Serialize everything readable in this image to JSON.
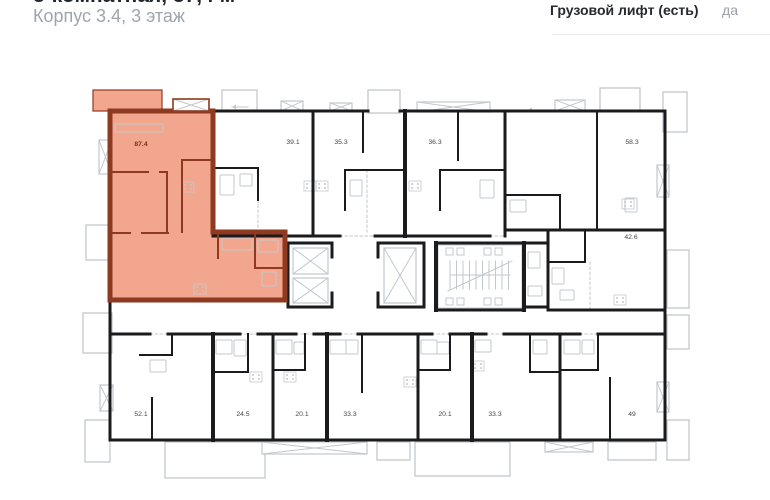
{
  "header": {
    "title": "3-комнатная, 87,4 м²",
    "subtitle": "Корпус 3.4, 3 этаж"
  },
  "info": {
    "label": "Грузовой лифт (есть)",
    "value": "да"
  },
  "colors": {
    "highlight_fill": "#F3A68E",
    "highlight_wall": "#8E3A21",
    "highlight_text": "#7C3118",
    "wall": "#1B1B1D",
    "light": "#C3C8CD",
    "label": "#41464C",
    "title": "#23262B",
    "muted": "#9AA0A8",
    "divider": "#ECECEE"
  },
  "floorplan": {
    "highlight": {
      "area_label": "87.4",
      "label_x": 141,
      "label_y": 146,
      "polygon": "110,111 213,111 213,232 285,232 285,300 110,300",
      "balcony": [
        93,
        90,
        69,
        21
      ],
      "hatch_red": [
        173,
        99,
        36,
        12
      ]
    },
    "unit_labels": [
      {
        "t": "39.1",
        "x": 293,
        "y": 144
      },
      {
        "t": "35.3",
        "x": 341,
        "y": 144
      },
      {
        "t": "36.3",
        "x": 435,
        "y": 144
      },
      {
        "t": "58.3",
        "x": 632,
        "y": 144
      },
      {
        "t": "42.6",
        "x": 631,
        "y": 239
      },
      {
        "t": "52.1",
        "x": 141,
        "y": 416
      },
      {
        "t": "24.5",
        "x": 243,
        "y": 416
      },
      {
        "t": "20.1",
        "x": 302,
        "y": 416
      },
      {
        "t": "33.3",
        "x": 350,
        "y": 416
      },
      {
        "t": "20.1",
        "x": 445,
        "y": 416
      },
      {
        "t": "33.3",
        "x": 495,
        "y": 416
      },
      {
        "t": "49",
        "x": 632,
        "y": 416
      }
    ],
    "walls_black": [
      [
        110,
        111,
        110,
        440
      ],
      [
        110,
        440,
        665,
        440
      ],
      [
        665,
        111,
        665,
        440
      ],
      [
        213,
        111,
        368,
        111
      ],
      [
        400,
        111,
        665,
        111
      ],
      [
        313,
        111,
        313,
        236
      ],
      [
        405,
        111,
        405,
        236,
        4
      ],
      [
        505,
        111,
        505,
        236
      ],
      [
        505,
        230,
        665,
        230
      ],
      [
        597,
        113,
        597,
        228,
        2
      ],
      [
        548,
        232,
        548,
        308
      ],
      [
        548,
        310,
        665,
        310
      ],
      [
        213,
        236,
        340,
        236
      ],
      [
        375,
        236,
        490,
        236
      ],
      [
        288,
        243,
        332,
        243
      ],
      [
        288,
        307,
        332,
        307
      ],
      [
        288,
        243,
        288,
        307
      ],
      [
        332,
        243,
        332,
        257
      ],
      [
        332,
        293,
        332,
        307
      ],
      [
        378,
        243,
        424,
        243
      ],
      [
        378,
        307,
        424,
        307
      ],
      [
        378,
        243,
        378,
        257
      ],
      [
        378,
        293,
        378,
        307
      ],
      [
        424,
        243,
        424,
        307
      ],
      [
        436,
        243,
        524,
        243
      ],
      [
        436,
        310,
        524,
        310
      ],
      [
        436,
        243,
        436,
        310,
        4
      ],
      [
        524,
        243,
        524,
        310,
        4
      ],
      [
        524,
        243,
        548,
        243
      ],
      [
        524,
        307,
        548,
        307
      ],
      [
        110,
        334,
        150,
        334
      ],
      [
        168,
        334,
        240,
        334
      ],
      [
        258,
        334,
        296,
        334
      ],
      [
        314,
        334,
        340,
        334
      ],
      [
        358,
        334,
        432,
        334
      ],
      [
        450,
        334,
        486,
        334
      ],
      [
        504,
        334,
        580,
        334
      ],
      [
        598,
        334,
        665,
        334
      ],
      [
        213,
        334,
        213,
        440,
        4
      ],
      [
        273,
        334,
        273,
        440
      ],
      [
        327,
        334,
        327,
        440,
        4
      ],
      [
        418,
        334,
        418,
        440
      ],
      [
        472,
        334,
        472,
        440,
        4
      ],
      [
        560,
        334,
        560,
        440
      ],
      [
        248,
        334,
        248,
        372,
        2
      ],
      [
        213,
        372,
        248,
        372,
        2
      ],
      [
        305,
        334,
        305,
        370,
        2
      ],
      [
        273,
        370,
        305,
        370,
        2
      ],
      [
        362,
        334,
        362,
        392,
        2
      ],
      [
        450,
        334,
        450,
        370,
        2
      ],
      [
        418,
        370,
        450,
        370,
        2
      ],
      [
        530,
        334,
        530,
        372,
        2
      ],
      [
        530,
        372,
        560,
        372,
        2
      ],
      [
        598,
        334,
        598,
        370,
        2
      ],
      [
        560,
        370,
        598,
        370,
        2
      ],
      [
        610,
        378,
        610,
        440,
        2
      ],
      [
        152,
        398,
        152,
        440,
        2
      ],
      [
        140,
        355,
        172,
        355,
        2
      ],
      [
        172,
        334,
        172,
        355,
        2
      ],
      [
        213,
        168,
        258,
        168,
        2
      ],
      [
        258,
        168,
        258,
        200,
        2
      ],
      [
        363,
        112,
        363,
        152,
        2
      ],
      [
        458,
        112,
        458,
        160,
        2
      ],
      [
        345,
        170,
        405,
        170,
        2
      ],
      [
        345,
        170,
        345,
        210,
        2
      ],
      [
        440,
        170,
        505,
        170,
        2
      ],
      [
        440,
        170,
        440,
        210,
        2
      ],
      [
        505,
        195,
        560,
        195,
        2
      ],
      [
        560,
        195,
        560,
        230,
        2
      ],
      [
        548,
        262,
        585,
        262,
        2
      ],
      [
        585,
        232,
        585,
        262,
        2
      ]
    ],
    "walls_red": [
      [
        110,
        111,
        110,
        300
      ],
      [
        110,
        111,
        213,
        111
      ],
      [
        213,
        111,
        213,
        232
      ],
      [
        213,
        232,
        285,
        232
      ],
      [
        285,
        232,
        285,
        300
      ],
      [
        110,
        300,
        285,
        300
      ]
    ],
    "walls_red_thin": [
      [
        110,
        172,
        148,
        172
      ],
      [
        160,
        172,
        167,
        172
      ],
      [
        167,
        172,
        167,
        232
      ],
      [
        110,
        233,
        130,
        233
      ],
      [
        142,
        233,
        168,
        233
      ],
      [
        182,
        160,
        213,
        160
      ],
      [
        182,
        160,
        182,
        232
      ],
      [
        255,
        235,
        255,
        268
      ],
      [
        255,
        268,
        285,
        268
      ],
      [
        218,
        232,
        218,
        258
      ]
    ],
    "balconies_outline": [
      [
        222,
        90,
        35,
        21
      ],
      [
        368,
        90,
        32,
        23
      ],
      [
        600,
        88,
        40,
        23
      ],
      [
        663,
        92,
        24,
        40
      ],
      [
        667,
        250,
        22,
        58
      ],
      [
        667,
        315,
        22,
        34
      ],
      [
        667,
        420,
        22,
        40
      ],
      [
        165,
        442,
        100,
        36
      ],
      [
        377,
        442,
        33,
        18
      ],
      [
        415,
        442,
        95,
        34
      ],
      [
        608,
        442,
        48,
        18
      ],
      [
        86,
        225,
        24,
        35
      ],
      [
        83,
        313,
        29,
        40
      ],
      [
        85,
        420,
        25,
        42
      ]
    ],
    "balconies_hatch": [
      [
        281,
        101,
        22,
        10
      ],
      [
        330,
        103,
        22,
        8
      ],
      [
        417,
        102,
        73,
        10
      ],
      [
        555,
        100,
        30,
        11
      ],
      [
        99,
        140,
        13,
        34
      ],
      [
        100,
        385,
        13,
        26
      ],
      [
        657,
        165,
        12,
        32
      ],
      [
        657,
        382,
        12,
        30
      ],
      [
        262,
        442,
        105,
        12
      ],
      [
        545,
        442,
        48,
        10
      ]
    ],
    "elevators": [
      [
        293,
        248,
        35,
        26
      ],
      [
        293,
        278,
        35,
        25
      ],
      [
        384,
        248,
        32,
        55
      ]
    ],
    "stair": {
      "x": 438,
      "y": 245,
      "w": 84,
      "h": 63
    },
    "stoves": [
      [
        188,
        187
      ],
      [
        310,
        186
      ],
      [
        322,
        186
      ],
      [
        415,
        186
      ],
      [
        628,
        204
      ],
      [
        620,
        300
      ],
      [
        256,
        377
      ],
      [
        290,
        377
      ],
      [
        410,
        382
      ],
      [
        478,
        366
      ],
      [
        200,
        289
      ]
    ],
    "fixtures": [
      [
        220,
        175,
        14,
        20
      ],
      [
        240,
        174,
        12,
        12
      ],
      [
        480,
        180,
        14,
        18
      ],
      [
        350,
        180,
        12,
        16
      ],
      [
        510,
        200,
        16,
        12
      ],
      [
        625,
        198,
        12,
        14
      ],
      [
        552,
        268,
        12,
        16
      ],
      [
        560,
        290,
        14,
        10
      ],
      [
        528,
        252,
        12,
        16
      ],
      [
        528,
        286,
        14,
        10
      ],
      [
        258,
        240,
        20,
        12
      ],
      [
        262,
        272,
        14,
        14
      ],
      [
        222,
        238,
        30,
        12
      ],
      [
        115,
        124,
        48,
        8
      ],
      [
        216,
        340,
        16,
        14
      ],
      [
        234,
        340,
        12,
        16
      ],
      [
        276,
        340,
        16,
        14
      ],
      [
        294,
        342,
        10,
        12
      ],
      [
        330,
        340,
        16,
        14
      ],
      [
        346,
        340,
        12,
        14
      ],
      [
        421,
        340,
        16,
        14
      ],
      [
        437,
        342,
        12,
        12
      ],
      [
        475,
        340,
        16,
        12
      ],
      [
        533,
        340,
        14,
        14
      ],
      [
        564,
        340,
        16,
        14
      ],
      [
        582,
        340,
        12,
        14
      ],
      [
        150,
        360,
        16,
        12
      ]
    ],
    "dotted": [
      [
        150,
        334,
        168,
        334
      ],
      [
        240,
        334,
        258,
        334
      ],
      [
        296,
        334,
        314,
        334
      ],
      [
        340,
        334,
        358,
        334
      ],
      [
        432,
        334,
        450,
        334
      ],
      [
        486,
        334,
        504,
        334
      ],
      [
        580,
        334,
        598,
        334
      ],
      [
        340,
        236,
        375,
        236
      ],
      [
        490,
        236,
        505,
        236
      ],
      [
        367,
        170,
        367,
        232
      ],
      [
        258,
        200,
        258,
        236
      ],
      [
        590,
        262,
        590,
        310
      ]
    ],
    "arrows": [
      [
        248,
        107,
        232,
        107
      ],
      [
        545,
        110,
        528,
        110
      ]
    ]
  }
}
